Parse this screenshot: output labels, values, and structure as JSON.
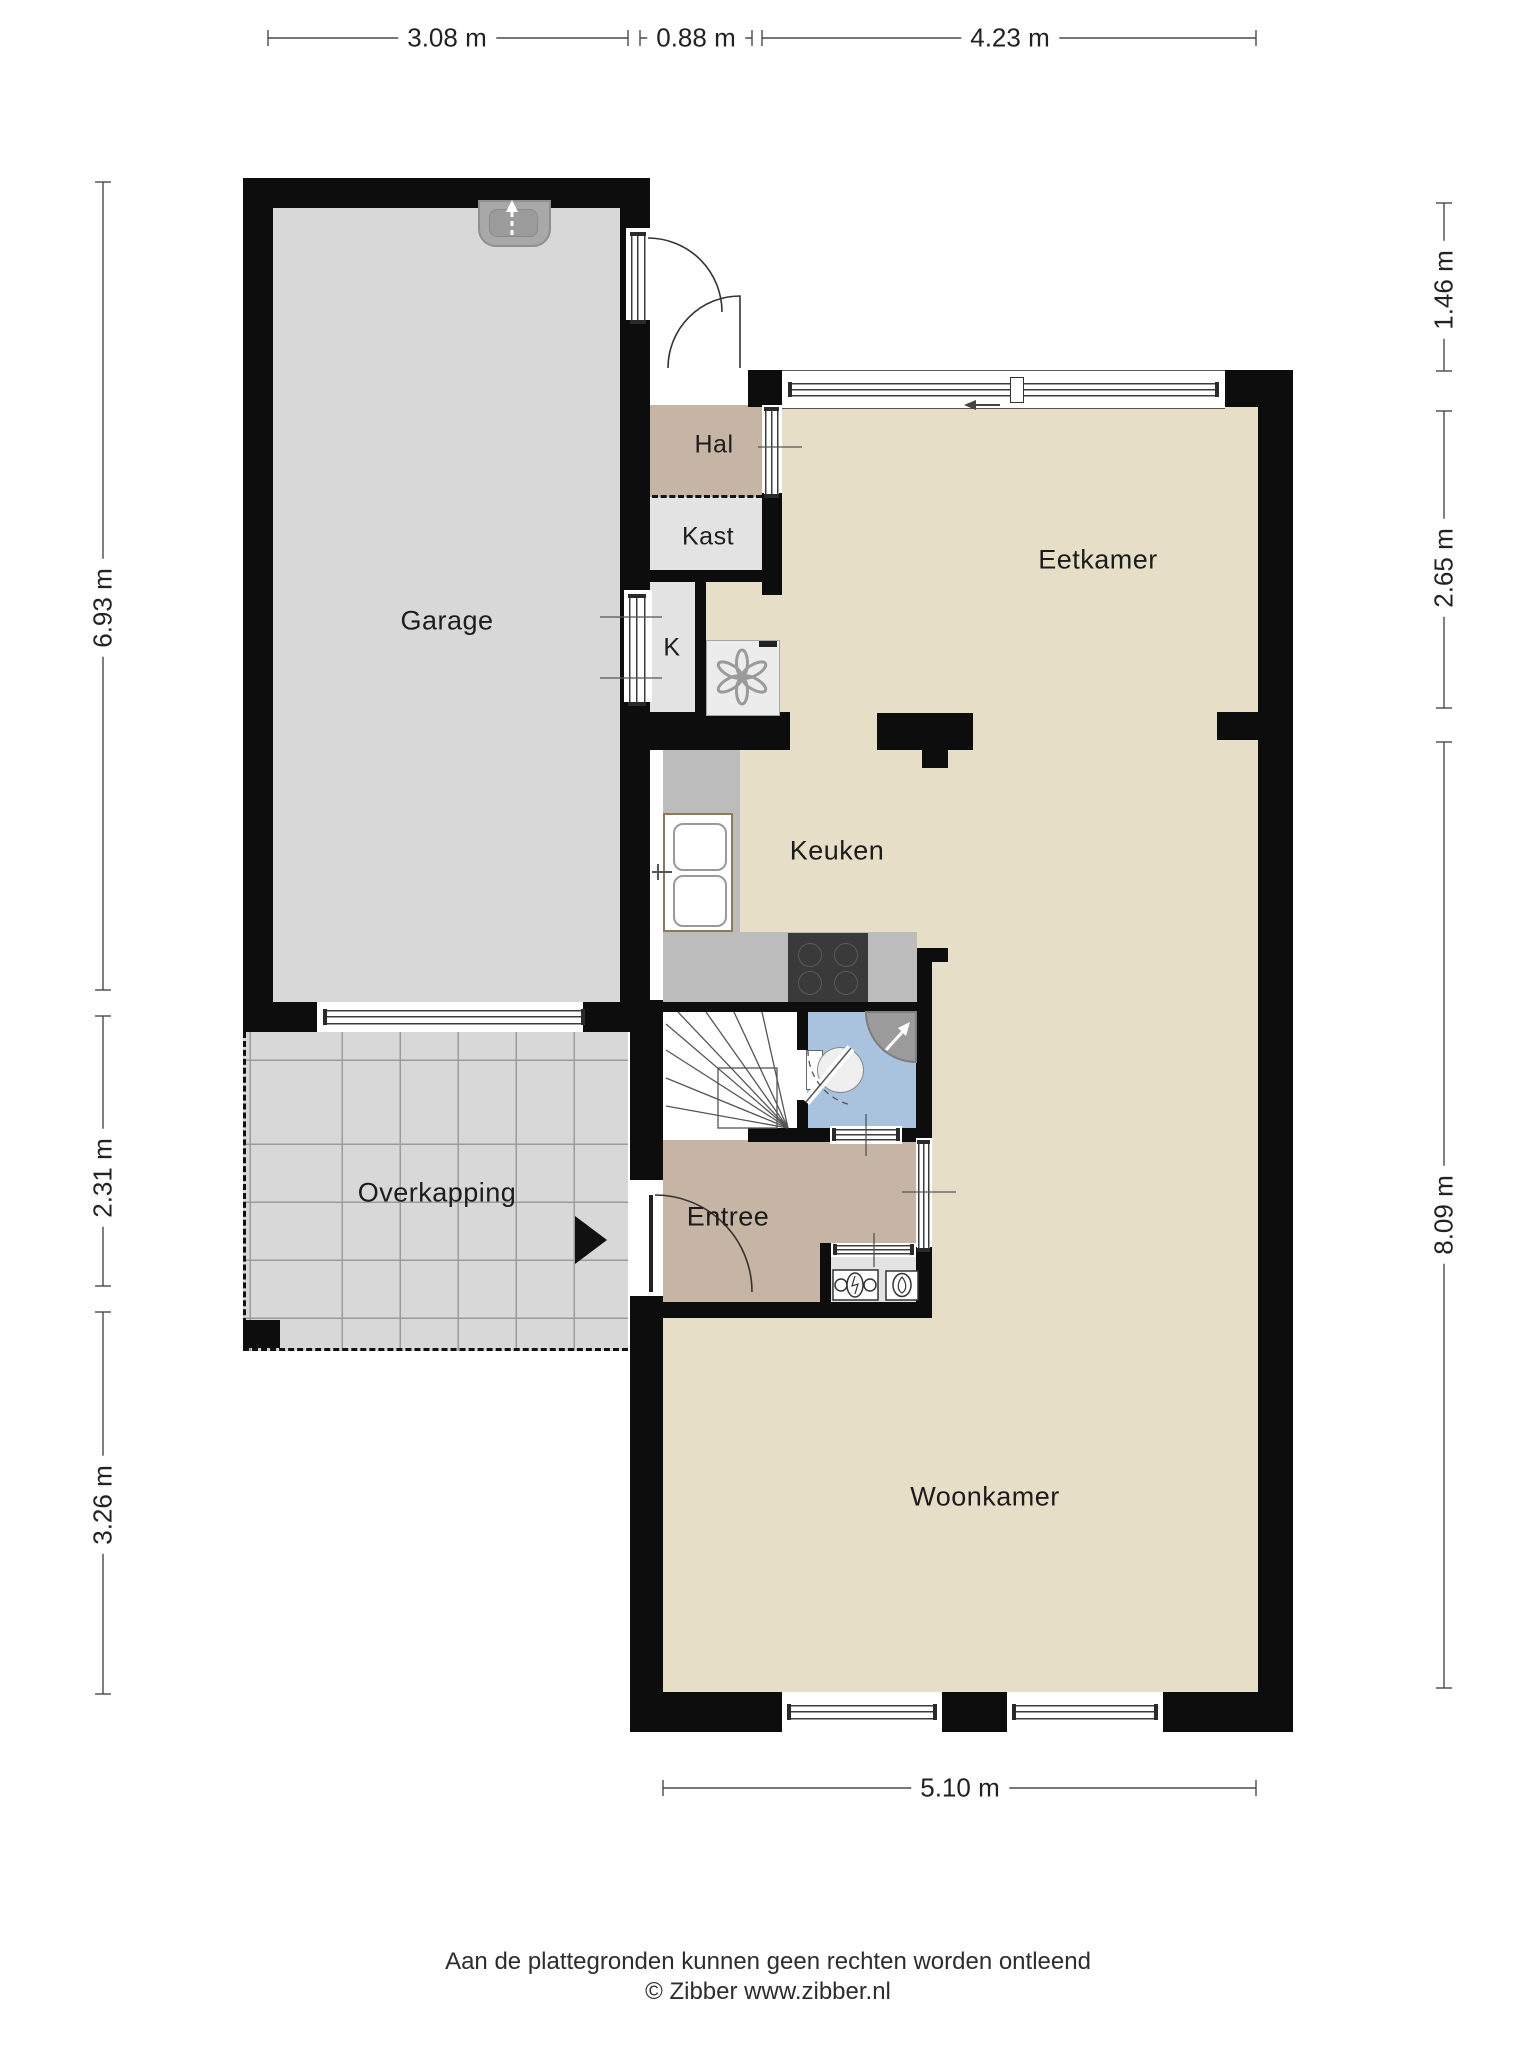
{
  "rooms": {
    "garage": {
      "label": "Garage"
    },
    "hal": {
      "label": "Hal"
    },
    "kast": {
      "label": "Kast"
    },
    "k": {
      "label": "K"
    },
    "eetkamer": {
      "label": "Eetkamer"
    },
    "keuken": {
      "label": "Keuken"
    },
    "overkapping": {
      "label": "Overkapping"
    },
    "entree": {
      "label": "Entree"
    },
    "woonkamer": {
      "label": "Woonkamer"
    }
  },
  "dimensions": {
    "top": [
      {
        "label": "3.08 m"
      },
      {
        "label": "0.88 m"
      },
      {
        "label": "4.23 m"
      }
    ],
    "left": [
      {
        "label": "6.93 m"
      },
      {
        "label": "2.31 m"
      },
      {
        "label": "3.26 m"
      }
    ],
    "right": [
      {
        "label": "1.46 m"
      },
      {
        "label": "2.65 m"
      },
      {
        "label": "8.09 m"
      }
    ],
    "bottom": [
      {
        "label": "5.10 m"
      }
    ]
  },
  "footer": {
    "disclaimer": "Aan de plattegronden kunnen geen rechten worden ontleend",
    "credit": "© Zibber www.zibber.nl"
  },
  "colors": {
    "wall": "#0d0d0d",
    "floor_living": "#e6dec6",
    "floor_garage": "#d8d8d8",
    "floor_hall": "#c6b5a5",
    "floor_closet": "#e3e3e3",
    "floor_toilet": "#a9c2dd",
    "counter": "#bcbcbc",
    "stove": "#3a3a3a",
    "dim_line": "#4a4a4a"
  }
}
